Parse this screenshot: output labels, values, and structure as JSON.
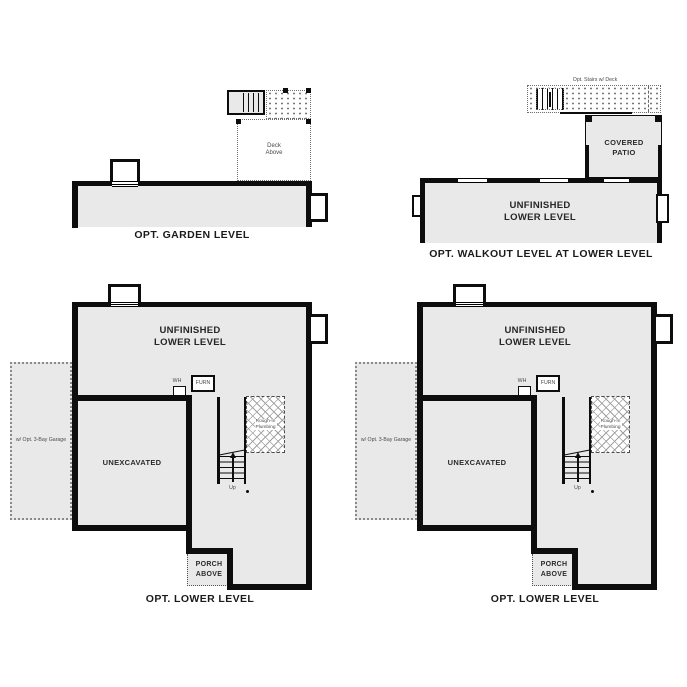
{
  "colors": {
    "background": "#ffffff",
    "wall": "#0d0d0d",
    "room_fill": "#e9e9e9",
    "dotted_line": "#6f6f6f",
    "text": "#1b1b1b"
  },
  "plans": {
    "garden": {
      "caption": "OPT. GARDEN LEVEL",
      "deck_label": "Deck\nAbove"
    },
    "walkout": {
      "caption": "OPT. WALKOUT LEVEL AT LOWER LEVEL",
      "room_label": "UNFINISHED\nLOWER LEVEL",
      "patio_label": "COVERED\nPATIO",
      "stairs_label": "Opt. Stairs w/ Deck"
    },
    "lower_left": {
      "caption": "OPT. LOWER LEVEL",
      "room_label": "UNFINISHED\nLOWER LEVEL",
      "unexcavated_label": "UNEXCAVATED",
      "garage_label": "w/ Opt. 3-Bay Garage",
      "porch_label": "PORCH\nABOVE",
      "wh_label": "WH",
      "furnace_label": "FURN",
      "stairs_up_label": "Up",
      "plumbing_label": "Rough-In\nPlumbing"
    },
    "lower_right": {
      "caption": "OPT. LOWER LEVEL",
      "room_label": "UNFINISHED\nLOWER LEVEL",
      "unexcavated_label": "UNEXCAVATED",
      "garage_label": "w/ Opt. 3-Bay Garage",
      "porch_label": "PORCH\nABOVE",
      "wh_label": "WH",
      "furnace_label": "FURN",
      "stairs_up_label": "Up",
      "plumbing_label": "Rough-In\nPlumbing"
    }
  }
}
